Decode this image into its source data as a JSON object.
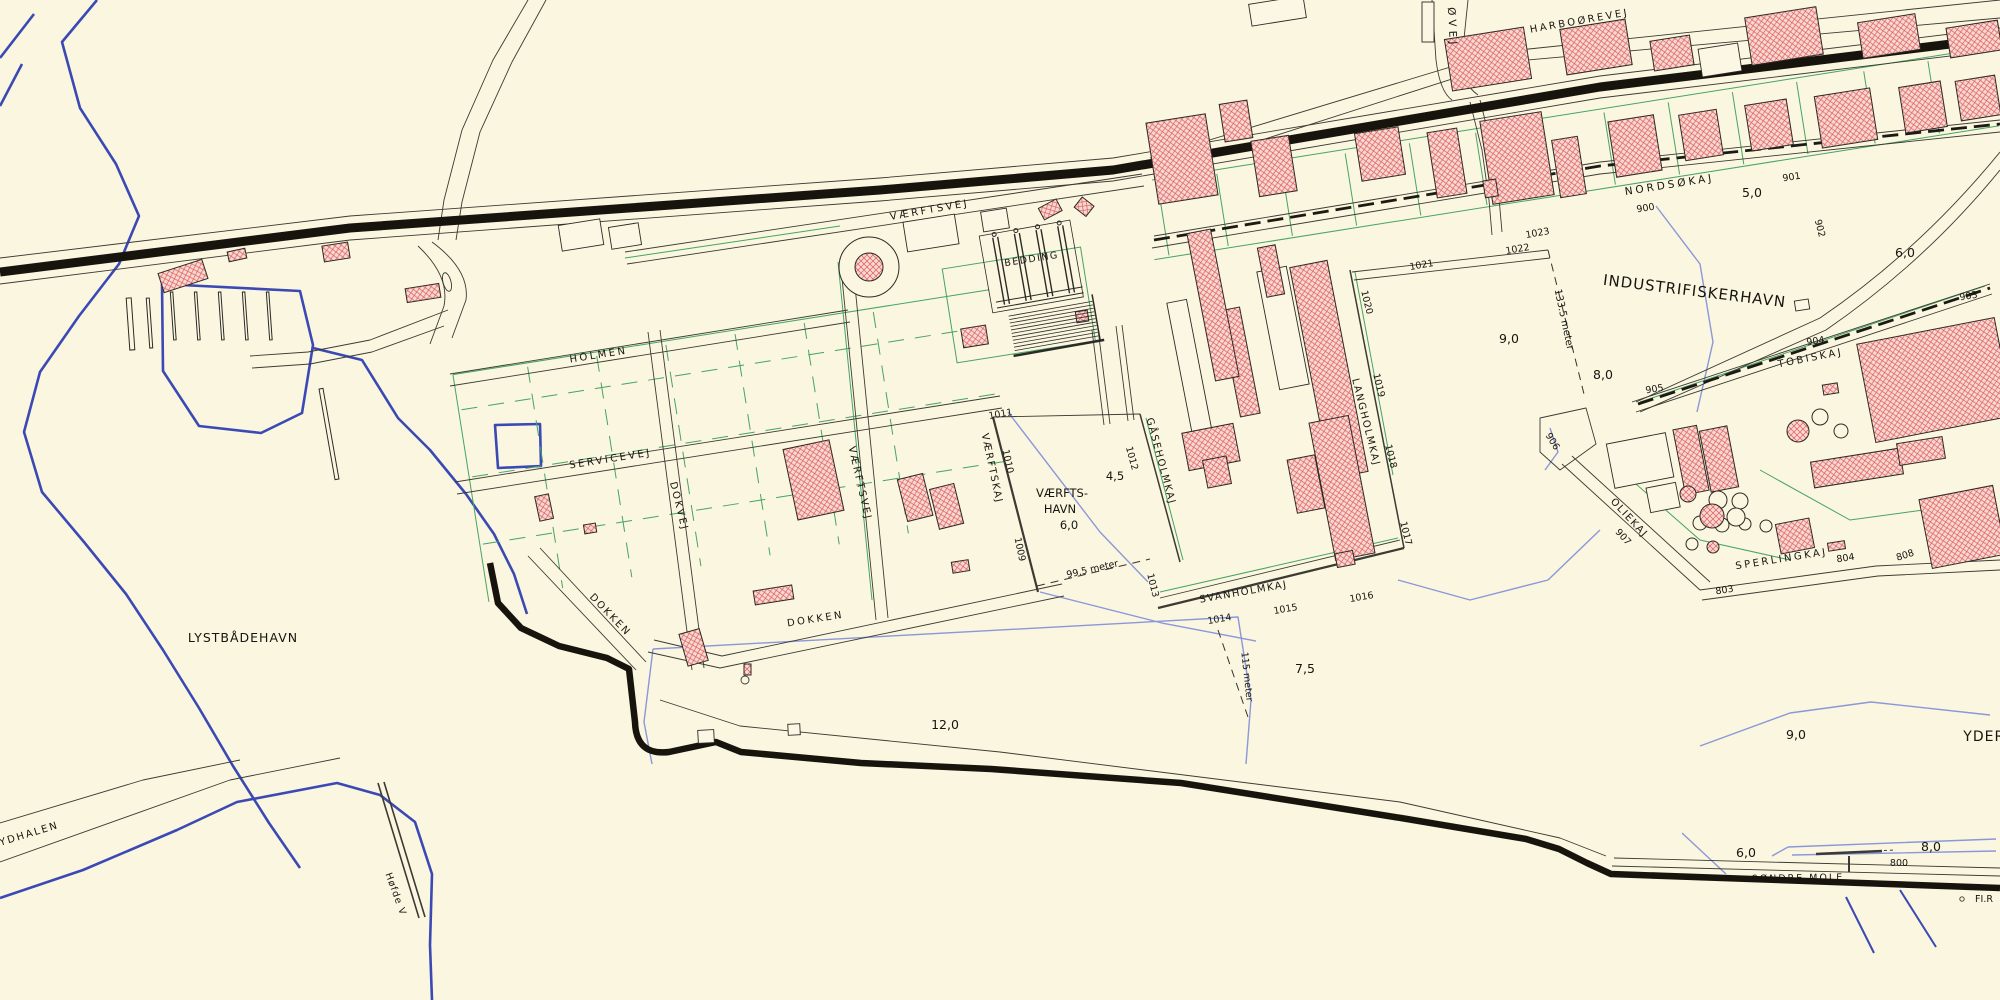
{
  "map": {
    "roads": {
      "harboorevej": "HARBOØREVEJ",
      "oevej": "ØVEJ",
      "vaerftsvej": "VÆRFTSVEJ",
      "vaerftsvej_south": "VÆRFTSVEJ",
      "holmen": "HOLMEN",
      "servicevej": "SERVICEVEJ",
      "dokvej": "DOKVEJ",
      "dokken_west": "DOKKEN",
      "dokken_east": "DOKKEN"
    },
    "areas": {
      "lystbaadehavn": "LYSTBÅDEHAVN",
      "vaerftshavn_line1": "VÆRFTS-",
      "vaerftshavn_line2": "HAVN",
      "industrifiskerhavn": "INDUSTRIFISKERHAVN",
      "yderhavn_partial": "YDERH",
      "sydhalen": "SYDHALEN",
      "bedding": "BEDDING",
      "hoefde_v": "Høfde V"
    },
    "quays": {
      "nordsoekaj": "NORDSØKAJ",
      "tobiskaj": "TOBISKAJ",
      "oliekaj": "OLIEKAJ",
      "sperlingkaj": "SPERLINGKAJ",
      "langholmkaj": "LANGHOLMKAJ",
      "gaaseholmkaj": "GÅSEHOLMKAJ",
      "svanholmkaj": "SVANHOLMKAJ",
      "vaerftskaj": "VÆRFTSKAJ",
      "soendre_mole": "SØNDRE MOLE"
    },
    "berths": {
      "b800": "800",
      "b803": "803",
      "b804": "804",
      "b808": "808",
      "b900": "900",
      "b901": "901",
      "b902": "902",
      "b903": "903",
      "b904": "904",
      "b905": "905",
      "b906": "906",
      "b907": "907",
      "b1009": "1009",
      "b1010": "1010",
      "b1011": "1011",
      "b1012": "1012",
      "b1013": "1013",
      "b1014": "1014",
      "b1015": "1015",
      "b1016": "1016",
      "b1017": "1017",
      "b1018": "1018",
      "b1019": "1019",
      "b1020": "1020",
      "b1021": "1021",
      "b1022": "1022",
      "b1023": "1023"
    },
    "depths_m": {
      "d45": "4,5",
      "d50": "5,0",
      "d60_industri": "6,0",
      "d60_vaerftshavn": "6,0",
      "d60_soendre": "6,0",
      "d75": "7,5",
      "d80_industri": "8,0",
      "d80_soendre": "8,0",
      "d90_industri": "9,0",
      "d90_yderhavn": "9,0",
      "d120": "12,0"
    },
    "measurements": {
      "entrance_133": "133.5 meter",
      "basin_99": "99.5 meter",
      "basin_115": "115 meter"
    },
    "navigation": {
      "light_fir": "FI.R"
    },
    "colors": {
      "background": "#faf6df",
      "building_fill": "#f7d9d3",
      "building_hatch": "#df5a58",
      "outline": "#2b2a26",
      "road": "#17140e",
      "water_edge": "#3b49b4",
      "depth_contour": "#8b97da",
      "parcel_green": "#46a463"
    }
  }
}
